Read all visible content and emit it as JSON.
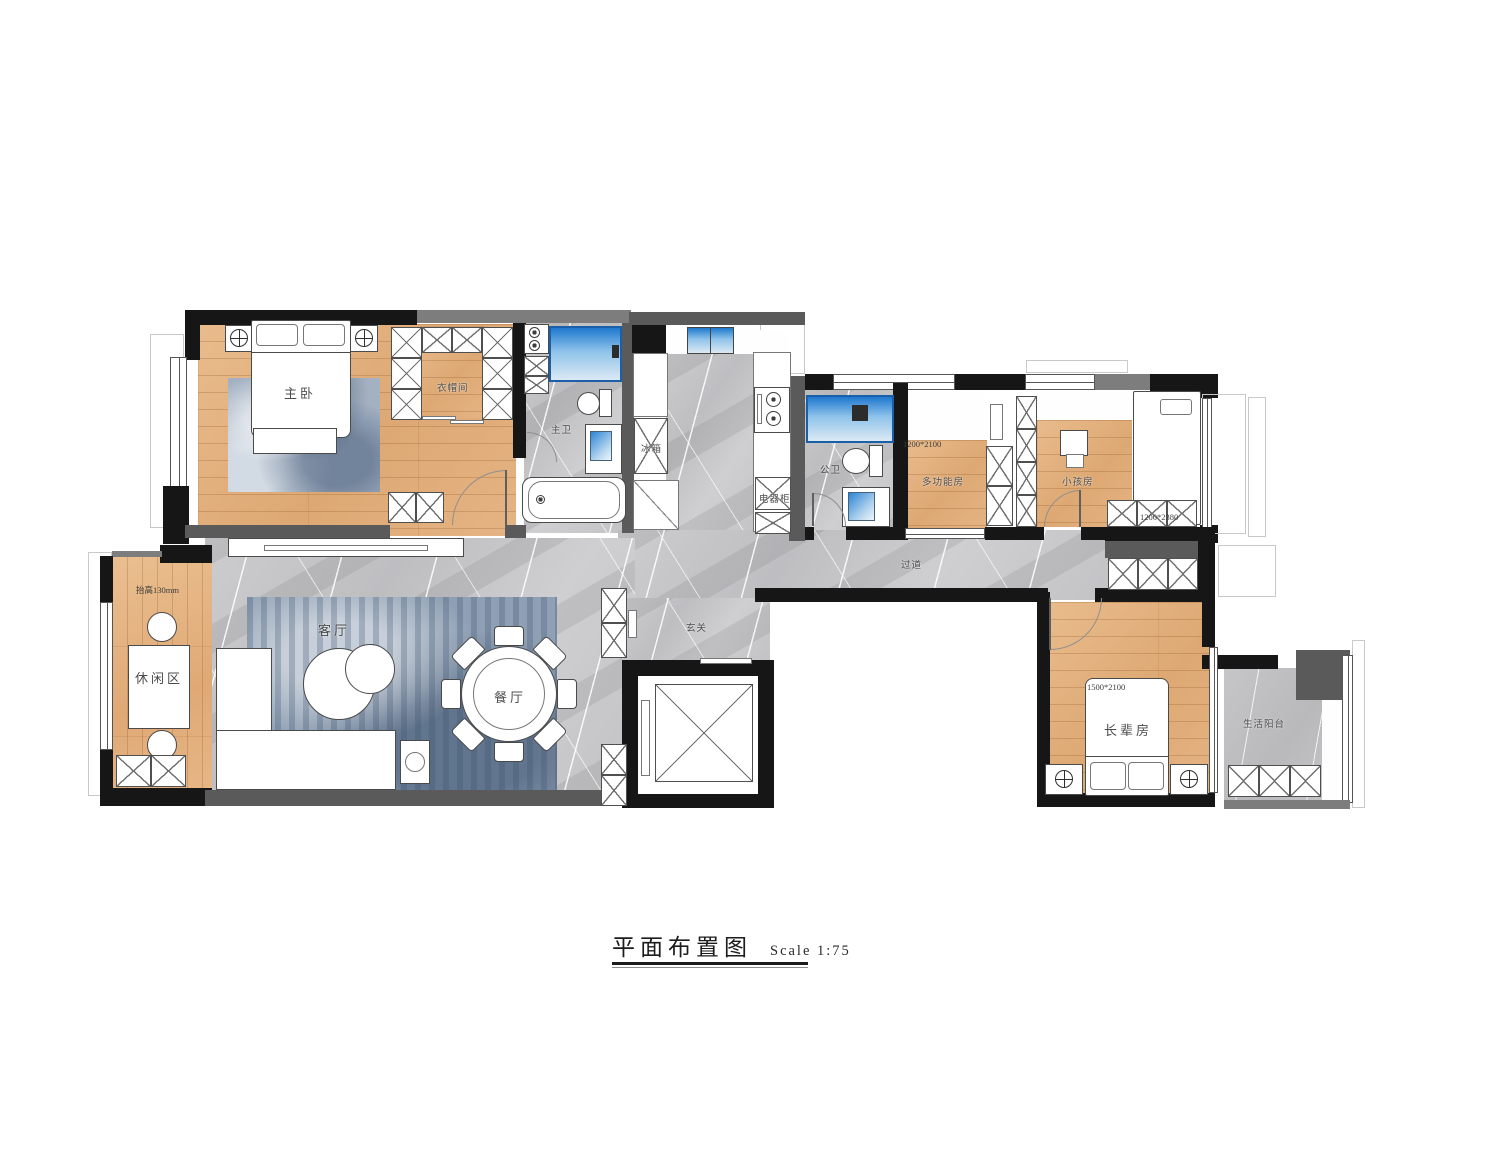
{
  "title": {
    "text": "平面布置图",
    "scale": "Scale 1:75"
  },
  "rooms": {
    "master_bedroom": {
      "label": "主卧"
    },
    "closet": {
      "label": "衣帽间"
    },
    "master_bath": {
      "label": "主卫"
    },
    "fridge": {
      "label": "冰箱"
    },
    "appliance_cabinet": {
      "label": "电器柜"
    },
    "guest_bath": {
      "label": "公卫"
    },
    "multi_room": {
      "label": "多功能房",
      "dim": "1200*2100"
    },
    "kids_room": {
      "label": "小孩房",
      "dim": "1200*2380"
    },
    "hallway": {
      "label": "过道"
    },
    "foyer": {
      "label": "玄关"
    },
    "leisure": {
      "label": "休闲区",
      "note": "抬高130mm"
    },
    "living": {
      "label": "客厅"
    },
    "dining": {
      "label": "餐厅"
    },
    "elders_room": {
      "label": "长辈房",
      "dim": "1500*2100"
    },
    "balcony": {
      "label": "生活阳台"
    }
  },
  "colors": {
    "wall": "#161616",
    "wood_floor": "#e3b184",
    "marble_floor": "#c7c7c9",
    "shower_blue": "#2e86d2",
    "rug_blue": "#9aa9bc"
  }
}
